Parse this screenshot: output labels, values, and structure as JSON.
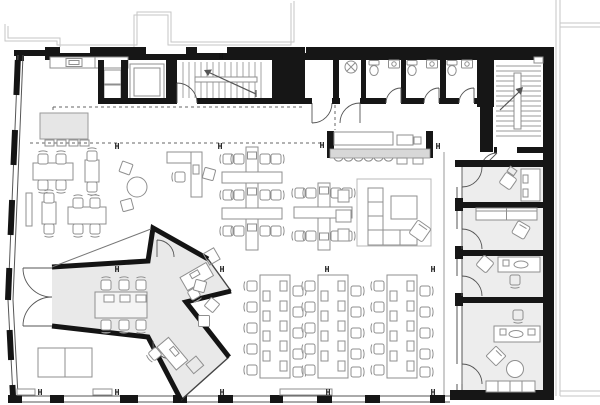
{
  "plan": {
    "marker_glyph": "H"
  },
  "colors": {
    "wall": "#161616",
    "pod_floor": "#e9e9e9",
    "office_floor": "#ededed",
    "counter_top": "#d8d8d8",
    "furniture_line": "#8f8f8f",
    "exterior_outline": "#c6c6c6",
    "zone_dash": "#666666",
    "background": "#ffffff"
  }
}
